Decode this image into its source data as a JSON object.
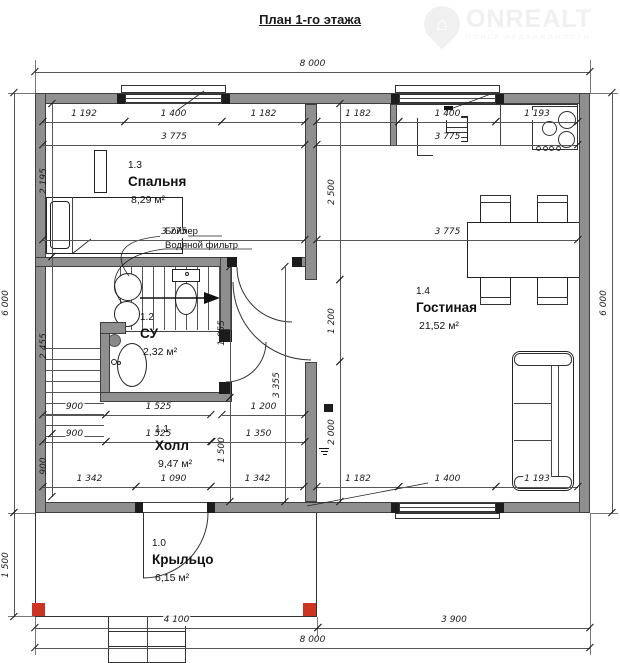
{
  "title": "План 1-го этажа",
  "watermark": {
    "brand": "ONREALT",
    "tagline": "ПОИСК НЕДВИЖИМОСТИ",
    "house_icon": "⌂"
  },
  "rooms": [
    {
      "id": "1.3",
      "name": "Спальня",
      "area": "8,29 м²",
      "x": 128,
      "y": 160
    },
    {
      "id": "1.2",
      "name": "СУ",
      "area": "2,32 м²",
      "x": 140,
      "y": 312
    },
    {
      "id": "1.1",
      "name": "Холл",
      "area": "9,47 м²",
      "x": 155,
      "y": 424
    },
    {
      "id": "1.4",
      "name": "Гостиная",
      "area": "21,52 м²",
      "x": 416,
      "y": 286
    },
    {
      "id": "1.0",
      "name": "Крыльцо",
      "area": "6,15 м²",
      "x": 152,
      "y": 538
    }
  ],
  "equipment_labels": [
    {
      "text": "Бойлер",
      "x": 165,
      "y": 226
    },
    {
      "text": "Водяной фильтр",
      "x": 165,
      "y": 240
    }
  ],
  "dims_h": [
    {
      "label": "8 000",
      "x1": 35,
      "x2": 590,
      "y": 72
    },
    {
      "label": "1 192",
      "x1": 43,
      "x2": 125,
      "y": 122
    },
    {
      "label": "1 400",
      "x1": 125,
      "x2": 222,
      "y": 122
    },
    {
      "label": "1 182",
      "x1": 222,
      "x2": 305,
      "y": 122
    },
    {
      "label": "1 182",
      "x1": 317,
      "x2": 399,
      "y": 122
    },
    {
      "label": "1 400",
      "x1": 399,
      "x2": 496,
      "y": 122
    },
    {
      "label": "1 193",
      "x1": 496,
      "x2": 578,
      "y": 122
    },
    {
      "label": "3 775",
      "x1": 43,
      "x2": 305,
      "y": 145
    },
    {
      "label": "3 775",
      "x1": 317,
      "x2": 578,
      "y": 145
    },
    {
      "label": "3 775",
      "x1": 43,
      "x2": 305,
      "y": 240
    },
    {
      "label": "3 775",
      "x1": 317,
      "x2": 578,
      "y": 240
    },
    {
      "label": "900",
      "x1": 43,
      "x2": 106,
      "y": 415
    },
    {
      "label": "1 525",
      "x1": 106,
      "x2": 211,
      "y": 415
    },
    {
      "label": "1 200",
      "x1": 222,
      "x2": 305,
      "y": 415
    },
    {
      "label": "900",
      "x1": 43,
      "x2": 106,
      "y": 442
    },
    {
      "label": "1 525",
      "x1": 106,
      "x2": 211,
      "y": 442
    },
    {
      "label": "1 350",
      "x1": 212,
      "x2": 305,
      "y": 442
    },
    {
      "label": "1 342",
      "x1": 43,
      "x2": 136,
      "y": 487
    },
    {
      "label": "1 090",
      "x1": 136,
      "x2": 211,
      "y": 487
    },
    {
      "label": "1 342",
      "x1": 211,
      "x2": 304,
      "y": 487
    },
    {
      "label": "1 182",
      "x1": 317,
      "x2": 399,
      "y": 487
    },
    {
      "label": "1 400",
      "x1": 399,
      "x2": 496,
      "y": 487
    },
    {
      "label": "1 193",
      "x1": 496,
      "x2": 578,
      "y": 487
    },
    {
      "label": "4 100",
      "x1": 35,
      "x2": 318,
      "y": 628
    },
    {
      "label": "3 900",
      "x1": 318,
      "x2": 590,
      "y": 628
    },
    {
      "label": "8 000",
      "x1": 35,
      "x2": 590,
      "y": 648
    }
  ],
  "dims_v": [
    {
      "label": "6 000",
      "y1": 93,
      "y2": 513,
      "x": 14
    },
    {
      "label": "1 500",
      "y1": 513,
      "y2": 617,
      "x": 14
    },
    {
      "label": "2 195",
      "y1": 104,
      "y2": 257,
      "x": 52
    },
    {
      "label": "2 455",
      "y1": 257,
      "y2": 434,
      "x": 52
    },
    {
      "label": "900",
      "y1": 434,
      "y2": 497,
      "x": 52
    },
    {
      "label": "1 855",
      "y1": 267,
      "y2": 398,
      "x": 230
    },
    {
      "label": "1 500",
      "y1": 398,
      "y2": 502,
      "x": 230
    },
    {
      "label": "3 355",
      "y1": 267,
      "y2": 502,
      "x": 285
    },
    {
      "label": "2 500",
      "y1": 104,
      "y2": 280,
      "x": 340
    },
    {
      "label": "1 200",
      "y1": 280,
      "y2": 362,
      "x": 340
    },
    {
      "label": "2 000",
      "y1": 362,
      "y2": 502,
      "x": 340
    },
    {
      "label": "6 000",
      "y1": 93,
      "y2": 513,
      "x": 612
    }
  ],
  "colors": {
    "wall": "#8f8f8f",
    "wall_edge": "#3f3f3f",
    "column_red": "#cc3322",
    "dim_line": "#555555",
    "text": "#1a1a1a"
  }
}
